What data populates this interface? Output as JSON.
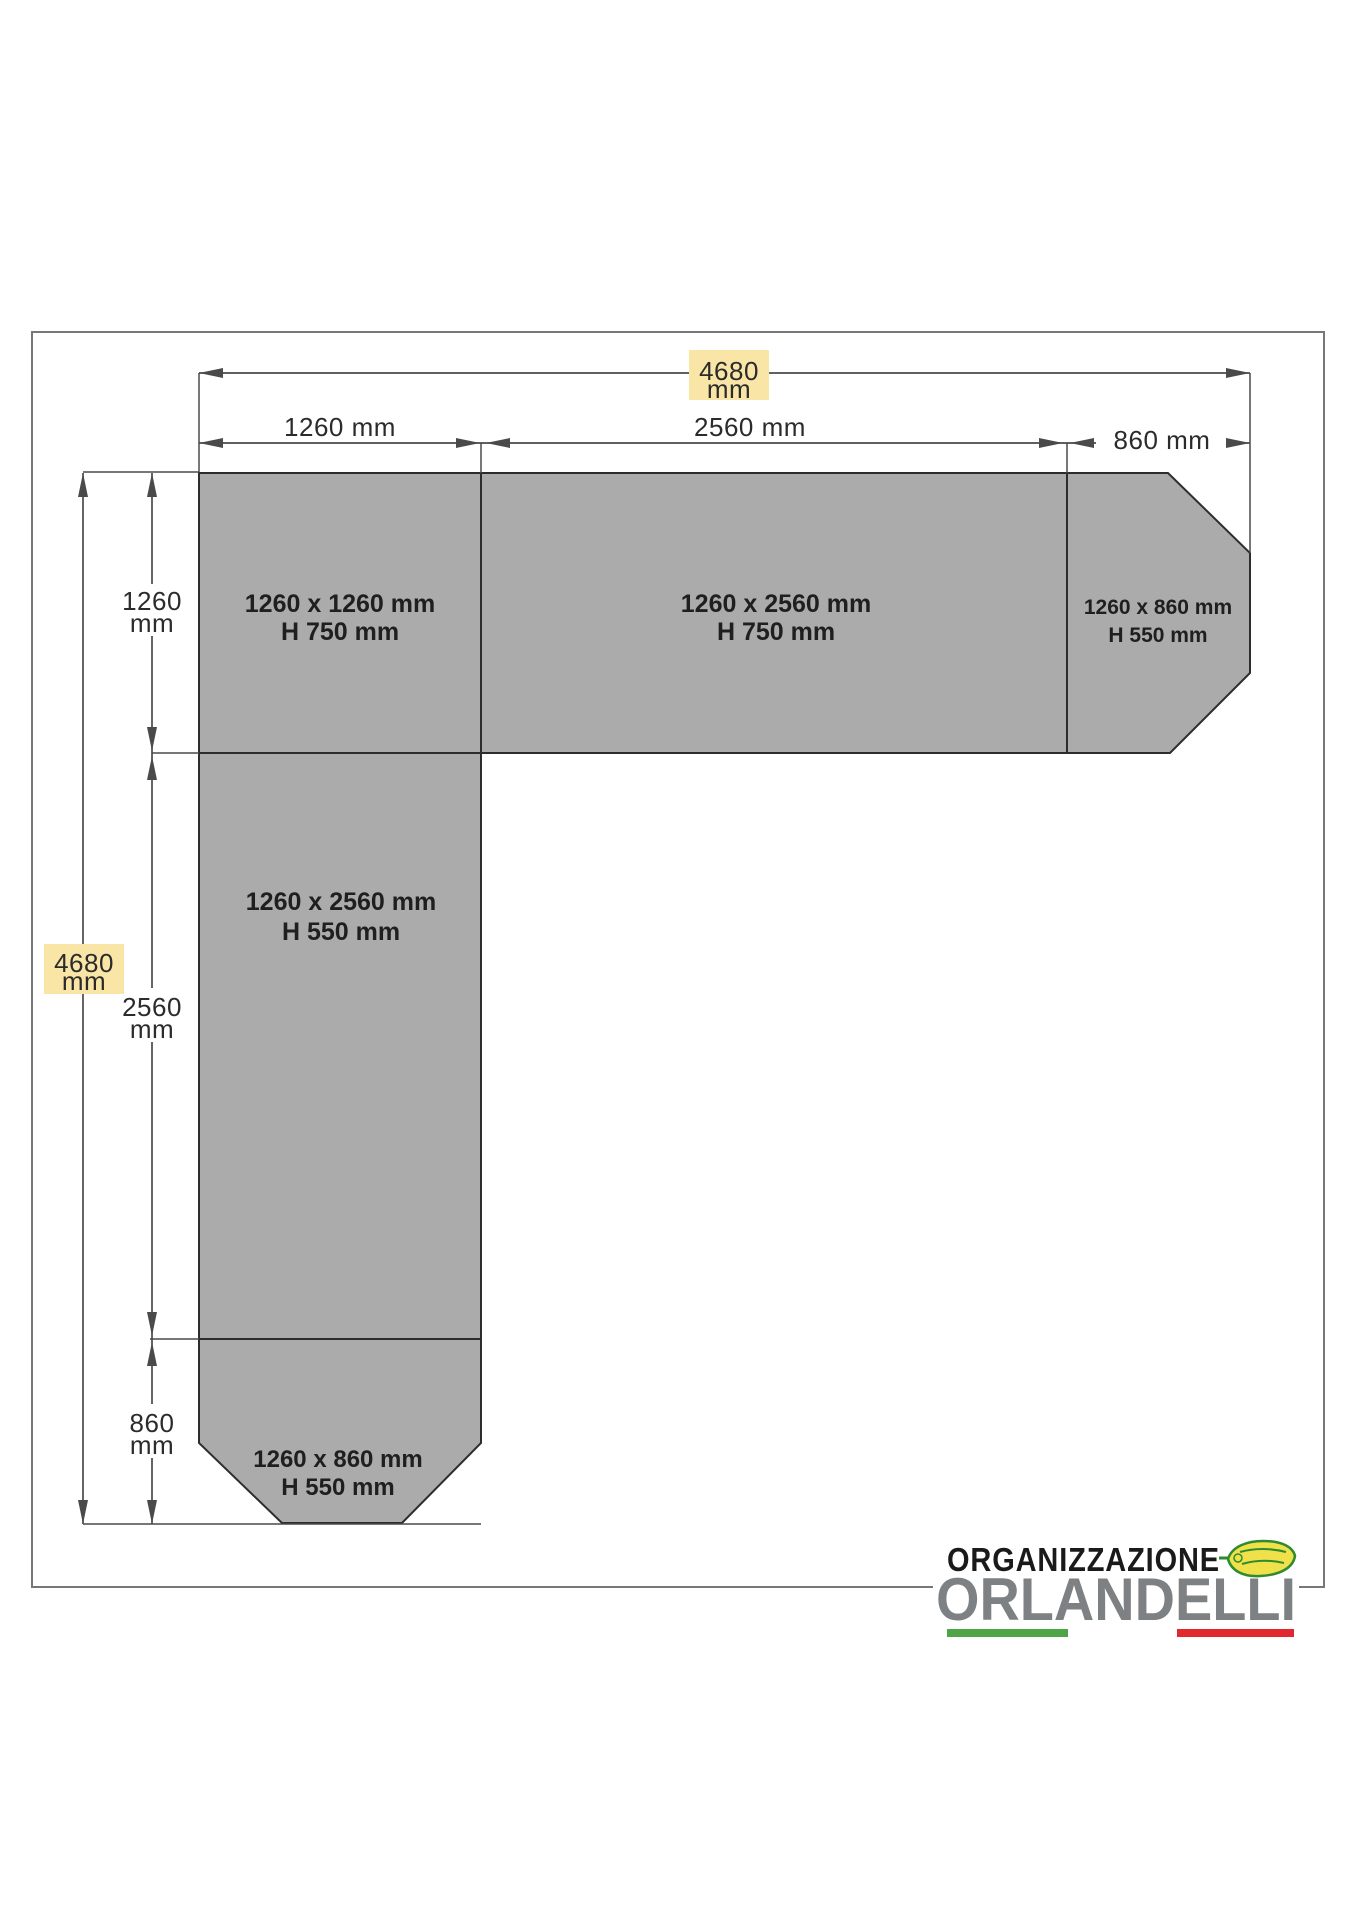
{
  "diagram": {
    "overall_width_label": {
      "value": "4680",
      "unit": "mm"
    },
    "overall_height_label": {
      "value": "4680",
      "unit": "mm"
    },
    "top_segments": [
      {
        "label": "1260 mm"
      },
      {
        "label": "2560 mm"
      },
      {
        "label": "860 mm"
      }
    ],
    "left_segments": [
      {
        "value": "1260",
        "unit": "mm"
      },
      {
        "value": "2560",
        "unit": "mm"
      },
      {
        "value": "860",
        "unit": "mm"
      }
    ],
    "panels": [
      {
        "id": "top-left",
        "size": "1260 x 1260 mm",
        "height": "H 750 mm"
      },
      {
        "id": "top-middle",
        "size": "1260 x 2560 mm",
        "height": "H 750 mm"
      },
      {
        "id": "top-right",
        "size": "1260 x 860 mm",
        "height": "H 550 mm"
      },
      {
        "id": "left-vertical",
        "size": "1260 x 2560 mm",
        "height": "H 550 mm"
      },
      {
        "id": "bottom-left",
        "size": "1260 x 860 mm",
        "height": "H 550 mm"
      }
    ]
  },
  "logo": {
    "organization": "ORGANIZZAZIONE",
    "name": "ORLANDELLI"
  },
  "colors": {
    "panel_fill": "#ababab",
    "panel_stroke": "#2d2d2d",
    "dimension_line": "#4a4a4a",
    "highlight_yellow": "#f9e6a6",
    "logo_gray": "#7e8184",
    "flag_green": "#4ea546",
    "flag_red": "#e0282e",
    "leaf_green": "#2e8b2e",
    "leaf_yellow": "#f0e14a",
    "border_gray": "#777777"
  }
}
